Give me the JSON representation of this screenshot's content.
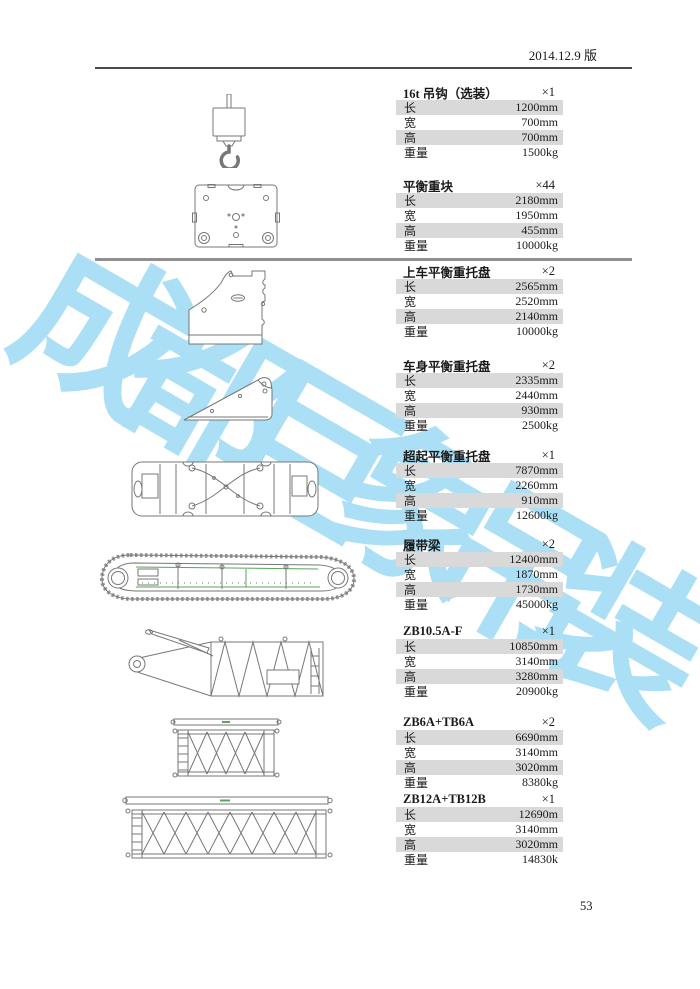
{
  "page": {
    "header": "2014.12.9 版",
    "page_number": "53",
    "watermark": "成都巨象吊装"
  },
  "labels": {
    "length": "长",
    "width": "宽",
    "height": "高",
    "weight": "重量"
  },
  "sections": [
    {
      "title": "16t 吊钩（选装）",
      "count": "×1",
      "length": "1200mm",
      "width": "700mm",
      "height": "700mm",
      "weight": "1500kg"
    },
    {
      "title": "平衡重块",
      "count": "×44",
      "length": "2180mm",
      "width": "1950mm",
      "height": "455mm",
      "weight": "10000kg"
    },
    {
      "title": "上车平衡重托盘",
      "count": "×2",
      "length": "2565mm",
      "width": "2520mm",
      "height": "2140mm",
      "weight": "10000kg"
    },
    {
      "title": "车身平衡重托盘",
      "count": "×2",
      "length": "2335mm",
      "width": "2440mm",
      "height": "930mm",
      "weight": "2500kg"
    },
    {
      "title": "超起平衡重托盘",
      "count": "×1",
      "length": "7870mm",
      "width": "2260mm",
      "height": "910mm",
      "weight": "12600kg"
    },
    {
      "title": "履带梁",
      "count": "×2",
      "length": "12400mm",
      "width": "1870mm",
      "height": "1730mm",
      "weight": "45000kg"
    },
    {
      "title": "ZB10.5A-F",
      "count": "×1",
      "length": "10850mm",
      "width": "3140mm",
      "height": "3280mm",
      "weight": "20900kg"
    },
    {
      "title": "ZB6A+TB6A",
      "count": "×2",
      "length": "6690mm",
      "width": "3140mm",
      "height": "3020mm",
      "weight": "8380kg"
    },
    {
      "title": "ZB12A+TB12B",
      "count": "×1",
      "length": "12690m",
      "width": "3140mm",
      "height": "3020mm",
      "weight": "14830k"
    }
  ],
  "drawings": [
    "hook-drawing",
    "counterweight-block-drawing",
    "upper-counterweight-tray-drawing",
    "carbody-counterweight-tray-drawing",
    "superlift-tray-drawing",
    "crawler-beam-drawing",
    "boom-butt-section-drawing",
    "lattice-section-short-drawing",
    "lattice-section-long-drawing"
  ],
  "colors": {
    "watermark": "#A6DEF5",
    "row_shading": "#D9D9D9",
    "drawing_stroke": "#777777",
    "drawing_green": "#5AA55A"
  }
}
